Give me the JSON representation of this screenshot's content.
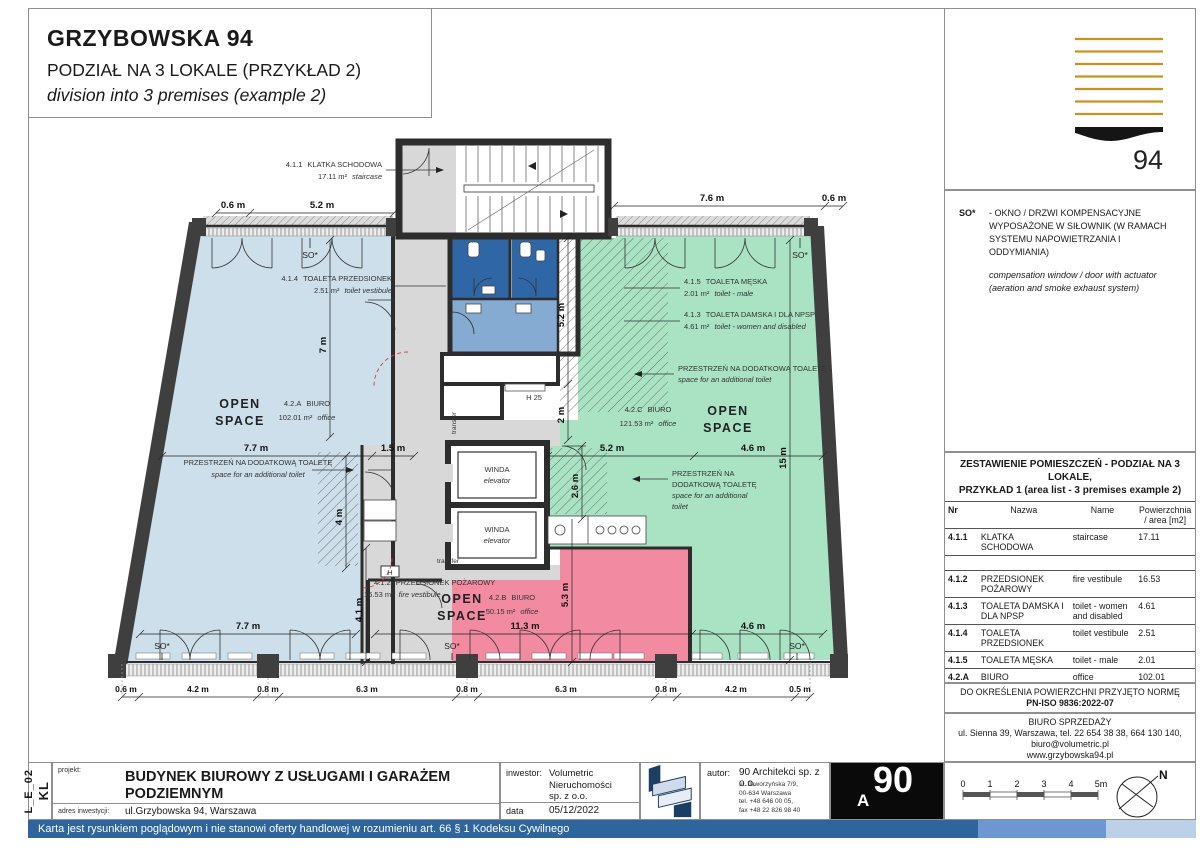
{
  "header": {
    "title": "GRZYBOWSKA 94",
    "subtitle_pl": "PODZIAŁ NA 3 LOKALE (PRZYKŁAD 2)",
    "subtitle_en": "division into 3 premises (example 2)"
  },
  "logo": {
    "number": "94"
  },
  "note": {
    "term": "SO*",
    "pl": "- OKNO / DRZWI KOMPENSACYJNE WYPOSAŻONE W SIŁOWNIK (W RAMACH SYSTEMU NAPOWIETRZANIA I ODDYMIANIA)",
    "en": "compensation window / door with actuator (aeration and smoke exhaust system)"
  },
  "area_table": {
    "title_line1": "ZESTAWIENIE POMIESZCZEŃ - PODZIAŁ NA 3 LOKALE,",
    "title_line2": "PRZYKŁAD 1 (area list - 3 premises example 2)",
    "headers": {
      "nr": "Nr",
      "nazwa": "Nazwa",
      "name": "Name",
      "area": "Powierzchnia / area [m2]"
    },
    "rows": [
      {
        "nr": "4.1.1",
        "nazwa": "KLATKA SCHODOWA",
        "name": "staircase",
        "area": "17.11"
      },
      {
        "nr": "",
        "nazwa": "",
        "name": "",
        "area": ""
      },
      {
        "nr": "4.1.2",
        "nazwa": "PRZEDSIONEK POŻAROWY",
        "name": "fire vestibule",
        "area": "16.53"
      },
      {
        "nr": "4.1.3",
        "nazwa": "TOALETA DAMSKA I DLA NPSP",
        "name": "toilet - women and disabled",
        "area": "4.61"
      },
      {
        "nr": "4.1.4",
        "nazwa": "TOALETA PRZEDSIONEK",
        "name": "toilet vestibule",
        "area": "2.51"
      },
      {
        "nr": "4.1.5",
        "nazwa": "TOALETA MĘSKA",
        "name": "toilet - male",
        "area": "2.01"
      },
      {
        "nr": "4.2.A",
        "nazwa": "BIURO",
        "name": "office",
        "area": "102.01"
      },
      {
        "nr": "4.2.B",
        "nazwa": "BIURO",
        "name": "office",
        "area": "50.15"
      },
      {
        "nr": "4.2.C",
        "nazwa": "BIURO",
        "name": "office",
        "area": "121.53"
      }
    ],
    "total_label": "ŁĄCZNA POW. NA SPRZEDAŻ",
    "total_value": "299.35"
  },
  "norm_note": {
    "line1": "DO OKREŚLENIA POWIERZCHNI PRZYJĘTO NORMĘ",
    "line2": "PN-ISO 9836:2022-07"
  },
  "sales_office": {
    "line1": "BIURO SPRZEDAŻY",
    "line2": "ul. Sienna 39, Warszawa, tel. 22 654 38 38, 664 130 140,",
    "line3": "biuro@volumetric.pl",
    "line4": "www.grzybowska94.pl"
  },
  "title_block": {
    "drawing_code_label": "nr rysunku",
    "drawing_code": "KL",
    "sheet_code": "L_E_02",
    "project_label": "projekt:",
    "project": "BUDYNEK BIUROWY Z USŁUGAMI I GARAŻEM PODZIEMNYM",
    "address_label": "adres inwestycji:",
    "address": "ul.Grzybowska 94, Warszawa",
    "investor_label": "inwestor:",
    "investor_line1": "Volumetric",
    "investor_line2": "Nieruchomości",
    "investor_line3": "sp. z o.o.",
    "date_label": "data",
    "date": "05/12/2022",
    "author_label": "autor:",
    "author": "90 Architekci sp. z o.o.",
    "author_addr1": "ul. Jaworzyńska 7/9,",
    "author_addr2": "00-634 Warszawa",
    "author_addr3": "tel. +48 646 00 05,",
    "author_addr4": "fax +48 22 826 98 40",
    "author_logo_num": "90",
    "author_logo_letter": "A"
  },
  "disclaimer": "Karta jest rysunkiem poglądowym i nie stanowi oferty handlowej w rozumieniu art. 66 § 1 Kodeksu Cywilnego",
  "scale_bar": {
    "labels": [
      "0",
      "1",
      "2",
      "3",
      "4",
      "5m"
    ]
  },
  "compass": {
    "north": "N"
  },
  "plan": {
    "so_label": "SO*",
    "open_space": {
      "l1": "OPEN",
      "l2": "SPACE"
    },
    "winda": {
      "pl": "WINDA",
      "en": "elevator"
    },
    "transfer": "transfer",
    "h25": "H 25",
    "h": "H",
    "toilet_note": {
      "pl": "PRZESTRZEŃ NA DODATKOWĄ TOALETĘ",
      "en": "space for an additional toilet",
      "pl1": "PRZESTRZEŃ NA",
      "pl2": "DODATKOWĄ TOALETĘ",
      "en1": "space for an additional",
      "en2": "toilet"
    },
    "rooms": [
      {
        "id": "4.1.1",
        "pl": "KLATKA SCHODOWA",
        "area": "17.11 m²",
        "en": "staircase"
      },
      {
        "id": "4.1.4",
        "pl": "TOALETA PRZEDSIONEK",
        "area": "2.51 m²",
        "en": "toilet vestibule"
      },
      {
        "id": "4.1.5",
        "pl": "TOALETA MĘSKA",
        "area": "2.01 m²",
        "en": "toilet - male"
      },
      {
        "id": "4.1.3",
        "pl": "TOALETA DAMSKA I DLA NPSP",
        "area": "4.61 m²",
        "en": "toilet - women and disabled"
      },
      {
        "id": "4.2.A",
        "pl": "BIURO",
        "area": "102.01 m²",
        "en": "office"
      },
      {
        "id": "4.2.C",
        "pl": "BIURO",
        "area": "121.53 m²",
        "en": "office"
      },
      {
        "id": "4.2.B",
        "pl": "BIURO",
        "area": "50.15 m²",
        "en": "office"
      },
      {
        "id": "4.1.2",
        "pl": "PRZEDSIONEK POŻAROWY",
        "area": "16.53 m²",
        "en": "fire vestibule"
      }
    ],
    "dims": [
      "0.6 m",
      "5.2 m",
      "7.6 m",
      "0.6 m",
      "7 m",
      "7.7 m",
      "1.5 m",
      "4 m",
      "7.7 m",
      "4.1 m",
      "5.2 m",
      "2 m",
      "2.6 m",
      "5.3 m",
      "5.2 m",
      "4.6 m",
      "15 m",
      "11.3 m",
      "4.6 m",
      "0.6 m",
      "4.2 m",
      "0.8 m",
      "6.3 m",
      "0.8 m",
      "6.3 m",
      "0.8 m",
      "4.2 m",
      "0.5 m"
    ]
  }
}
